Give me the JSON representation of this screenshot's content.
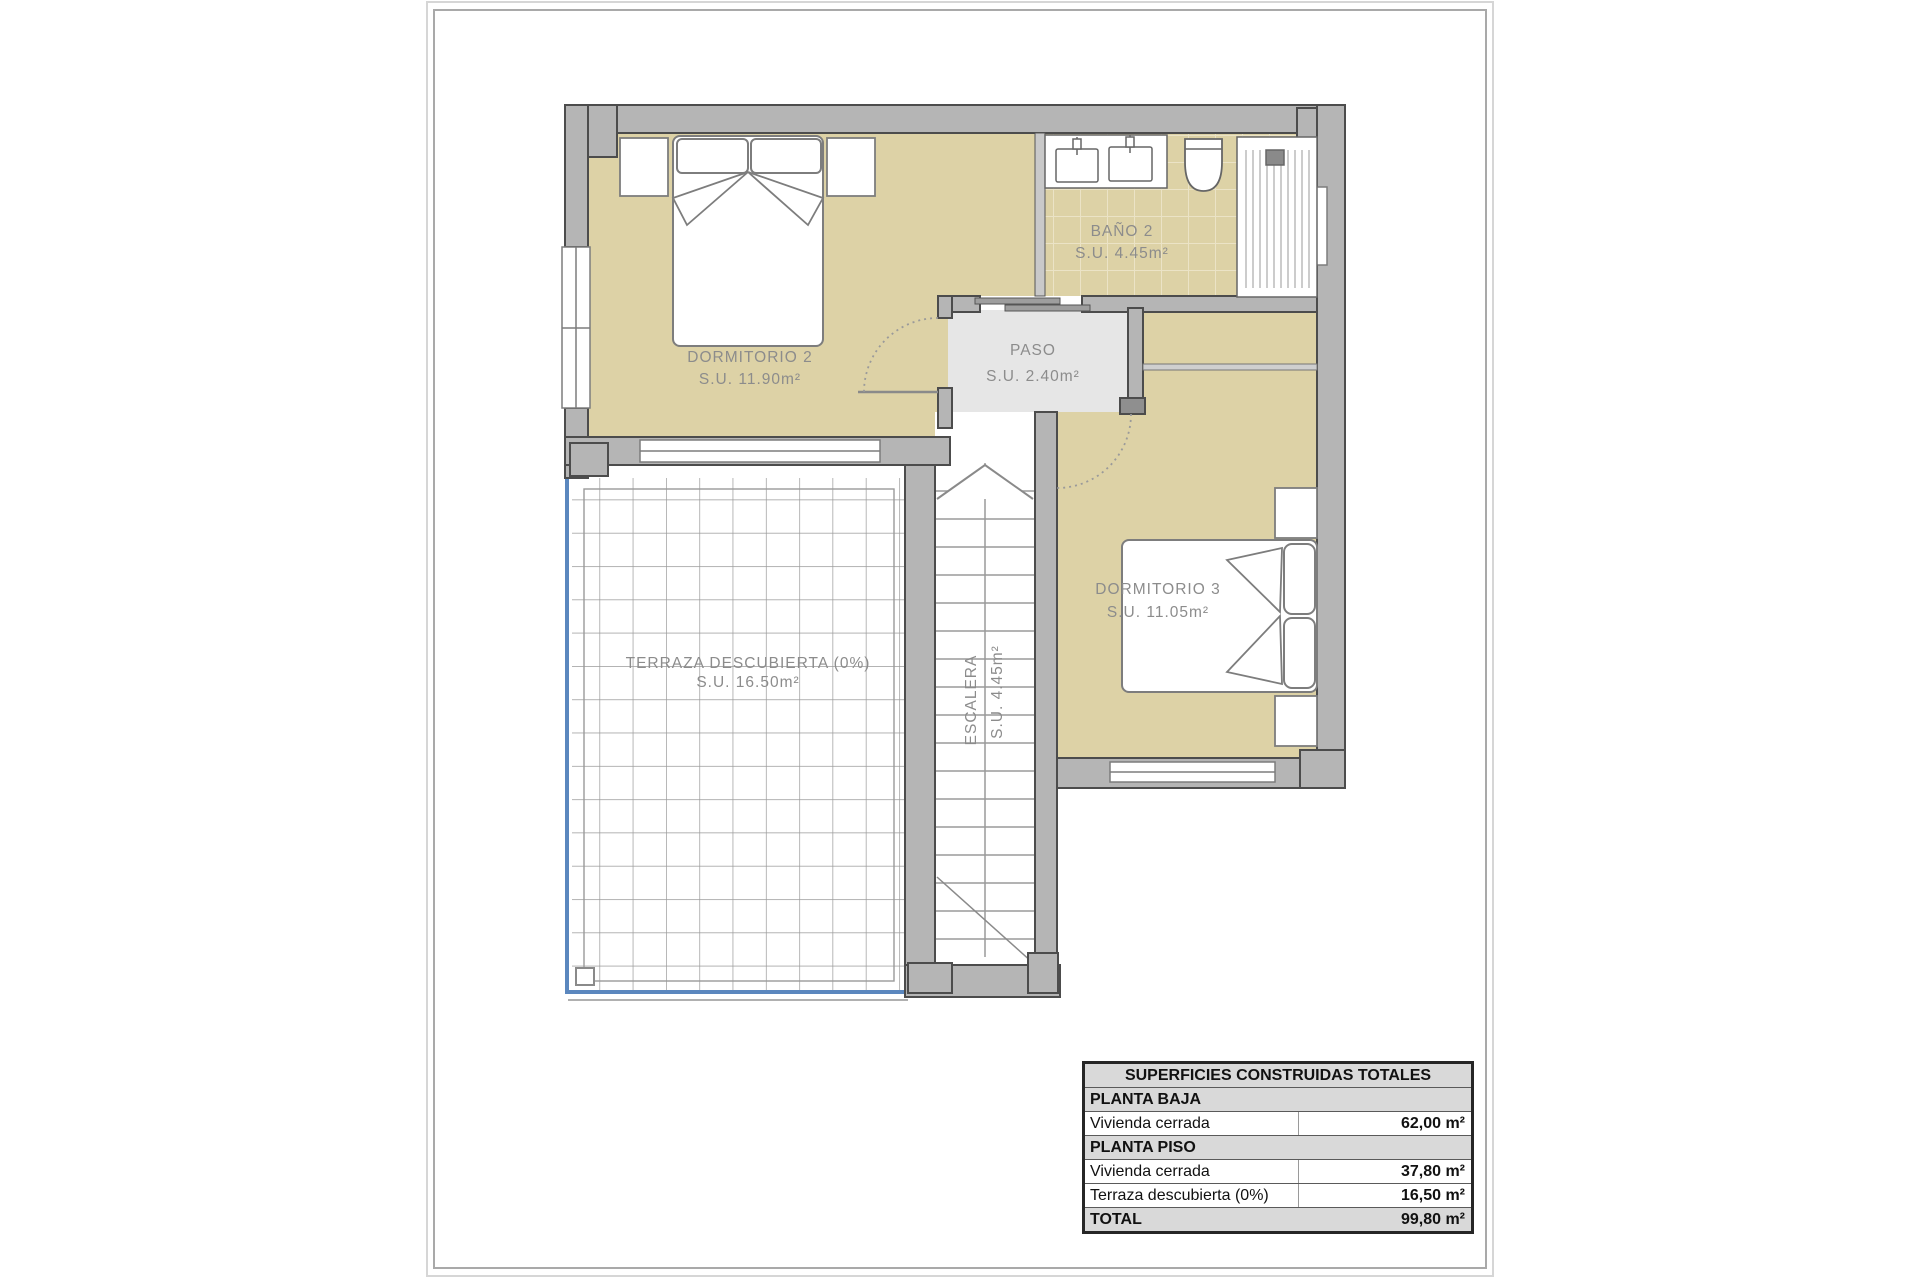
{
  "plan": {
    "rooms": [
      {
        "name": "DORMITORIO 2",
        "area": "S.U. 11.90m²"
      },
      {
        "name": "BAÑO 2",
        "area": "S.U. 4.45m²"
      },
      {
        "name": "PASO",
        "area": "S.U. 2.40m²"
      },
      {
        "name": "DORMITORIO 3",
        "area": "S.U. 11.05m²"
      },
      {
        "name": "TERRAZA DESCUBIERTA (0%)",
        "area": "S.U. 16.50m²"
      },
      {
        "name": "ESCALERA",
        "area": "S.U. 4.45m²"
      }
    ],
    "colors": {
      "room_floor": "#ddd2a6",
      "hall_floor": "#e6e6e6",
      "wall_fill": "#b5b5b5",
      "wall_outline": "#4c4c4c",
      "terrace_accent_blue": "#5b87be",
      "label_text": "#8c8c8c"
    }
  },
  "summary_table": {
    "title": "SUPERFICIES CONSTRUIDAS TOTALES",
    "rows": [
      {
        "label": "PLANTA BAJA",
        "value": ""
      },
      {
        "label": "Vivienda cerrada",
        "value": "62,00 m²"
      },
      {
        "label": "PLANTA PISO",
        "value": ""
      },
      {
        "label": "Vivienda cerrada",
        "value": "37,80 m²"
      },
      {
        "label": "Terraza descubierta (0%)",
        "value": "16,50 m²"
      },
      {
        "label": "TOTAL",
        "value": "99,80 m²"
      }
    ]
  }
}
